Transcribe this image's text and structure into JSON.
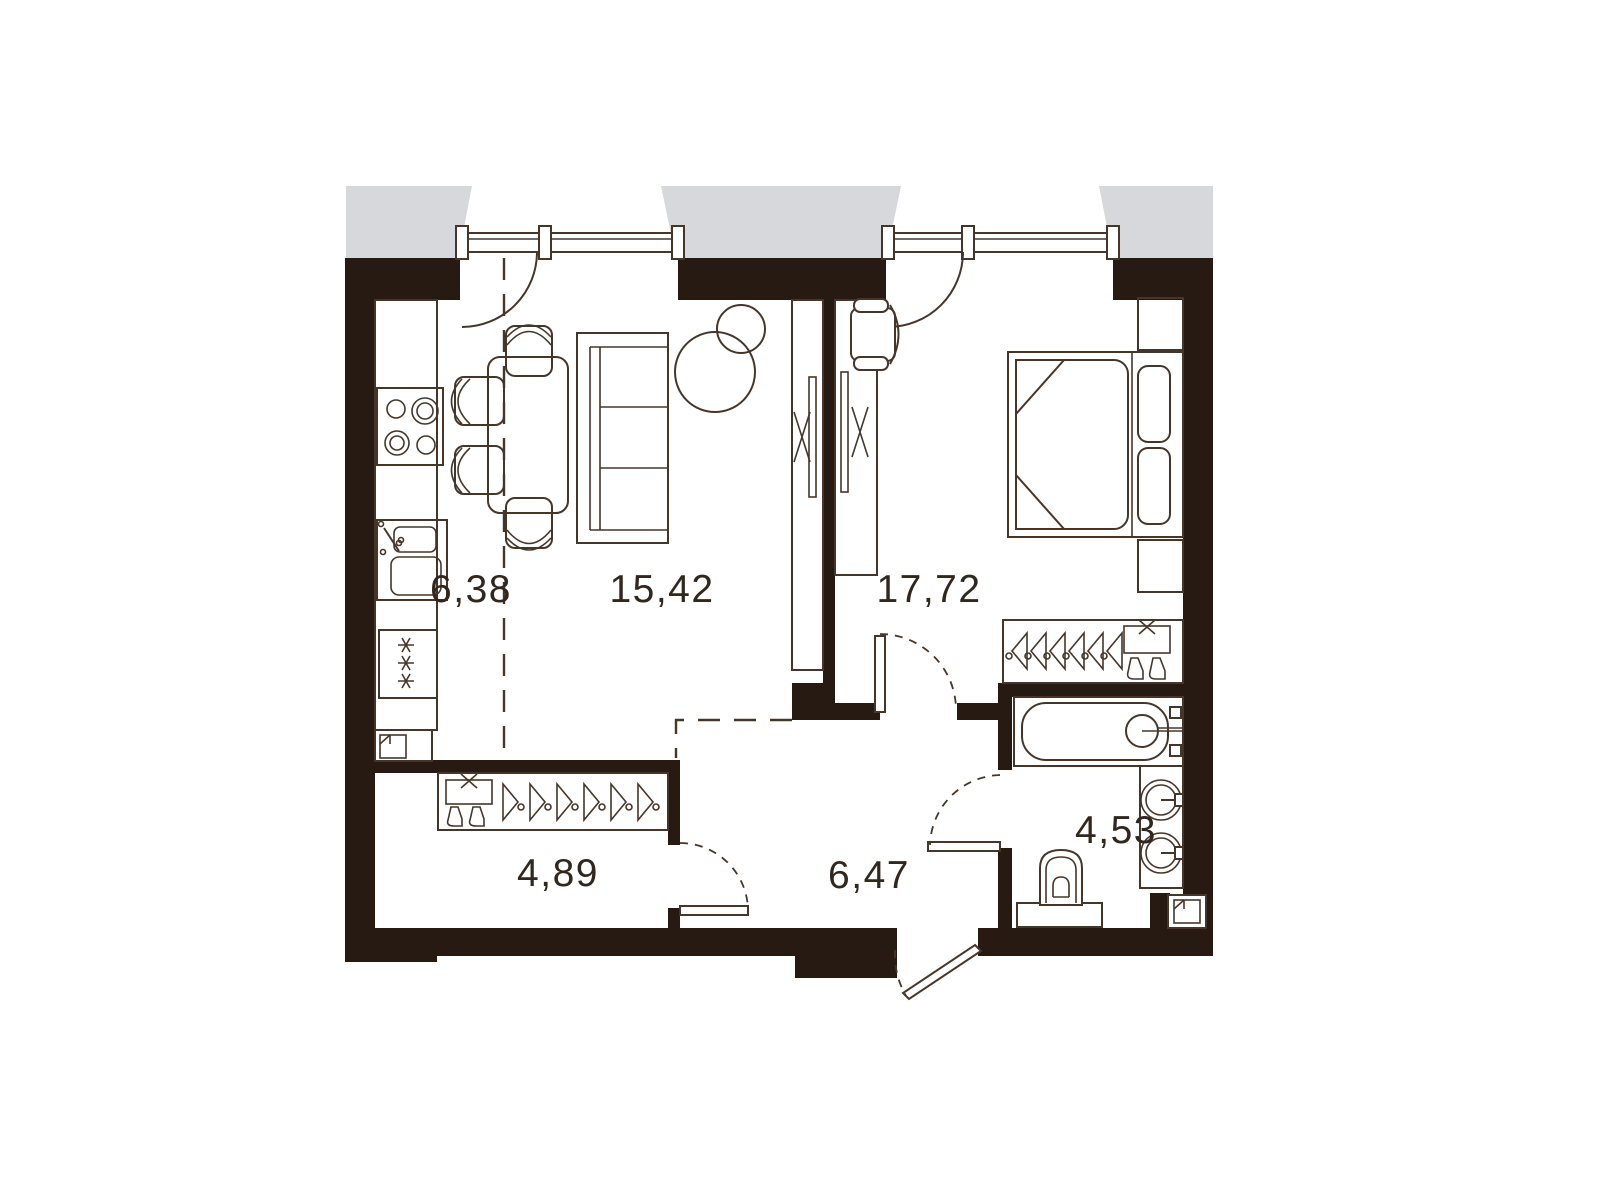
{
  "floorplan": {
    "title": "one-bedroom-apartment-floor-plan",
    "colors": {
      "wall": "#271a12",
      "line": "#46362a",
      "balcony": "#d6d8db",
      "label": "#30271f",
      "background": "#ffffff"
    },
    "rooms": [
      {
        "name": "kitchen",
        "area": "6,38"
      },
      {
        "name": "living-room",
        "area": "15,42"
      },
      {
        "name": "bedroom",
        "area": "17,72"
      },
      {
        "name": "hallway",
        "area": "4,89"
      },
      {
        "name": "corridor",
        "area": "6,47"
      },
      {
        "name": "bathroom",
        "area": "4,53"
      }
    ],
    "fixtures": [
      "stove-icon",
      "sink-icon",
      "fridge-icon",
      "vent-shaft-icon",
      "dining-table",
      "dining-chairs",
      "sofa",
      "floor-lamp",
      "sliding-wardrobe",
      "armchair",
      "double-bed",
      "nightstands",
      "hanger-wardrobe",
      "shirt-icon",
      "boots-icon",
      "bathtub",
      "washbasins",
      "toilet",
      "window",
      "balcony-door",
      "entrance-door"
    ]
  }
}
